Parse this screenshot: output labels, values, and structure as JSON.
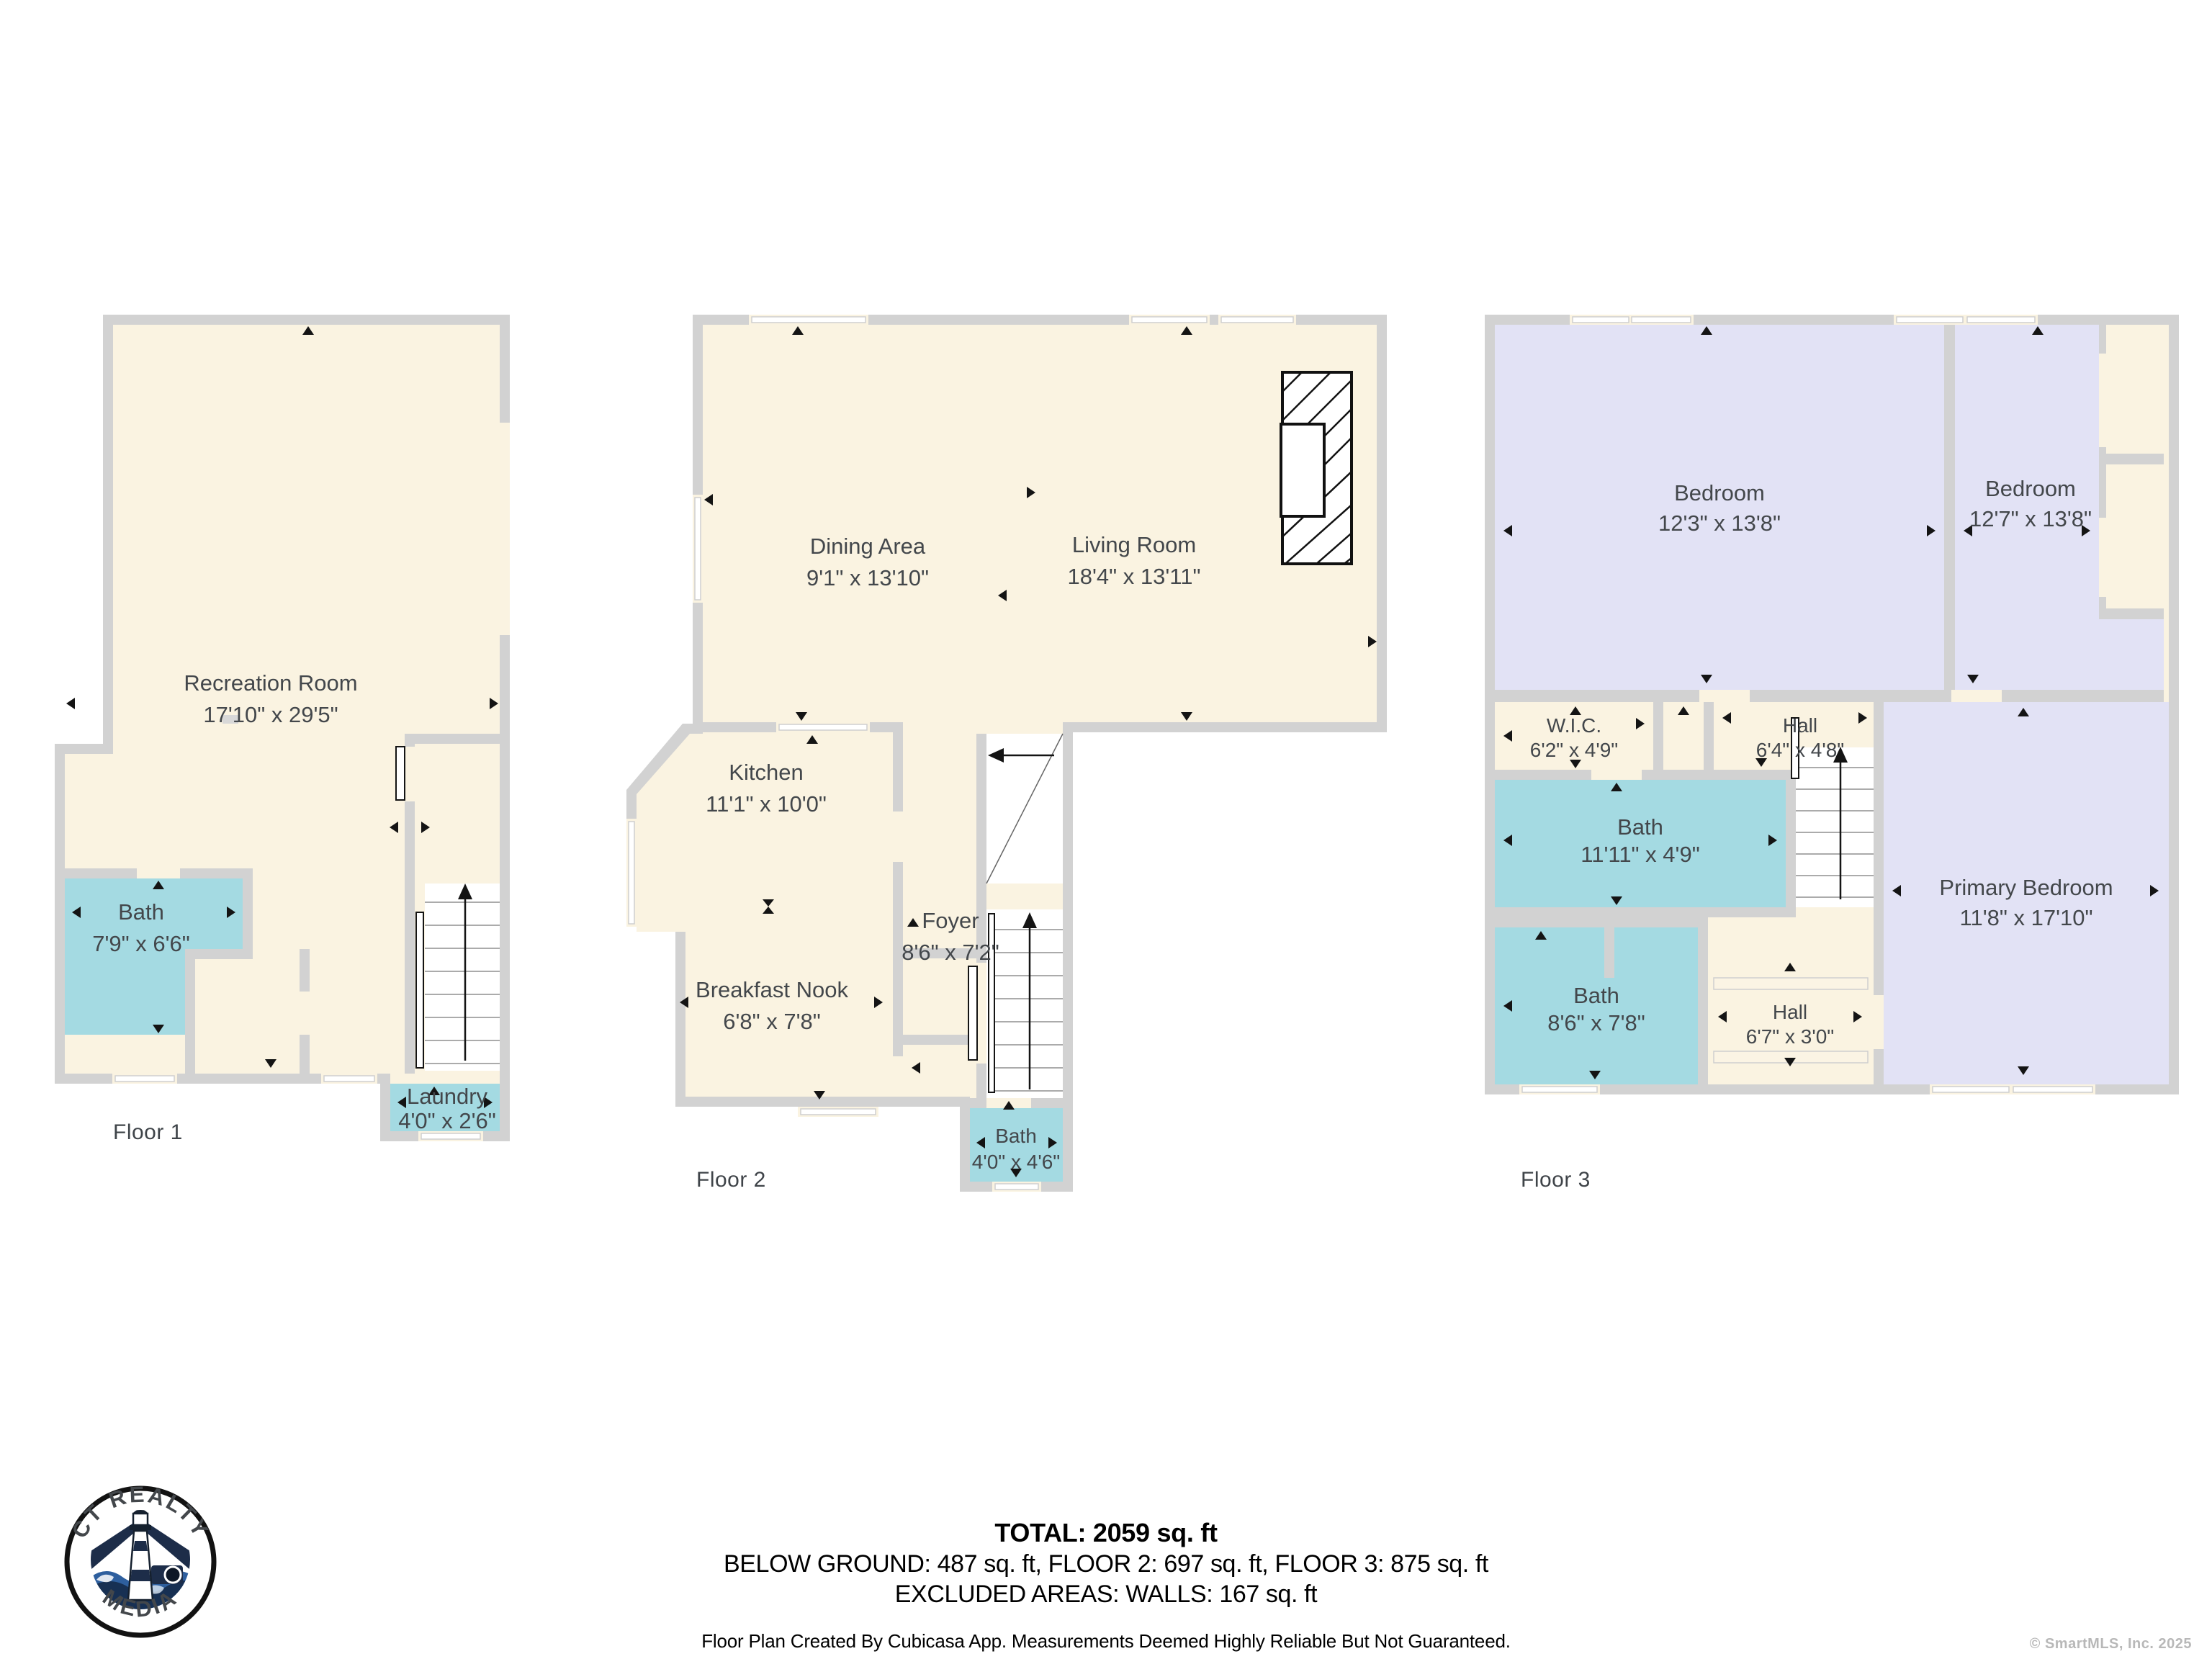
{
  "floors": [
    {
      "title": "Floor 1",
      "rooms": [
        {
          "name": "Recreation Room",
          "dims": "17'10\" x 29'5\""
        },
        {
          "name": "Bath",
          "dims": "7'9\" x 6'6\""
        },
        {
          "name": "Laundry",
          "dims": "4'0\" x 2'6\""
        }
      ]
    },
    {
      "title": "Floor 2",
      "rooms": [
        {
          "name": "Dining Area",
          "dims": "9'1\" x 13'10\""
        },
        {
          "name": "Living Room",
          "dims": "18'4\" x 13'11\""
        },
        {
          "name": "Kitchen",
          "dims": "11'1\" x 10'0\""
        },
        {
          "name": "Foyer",
          "dims": "8'6\" x 7'2\""
        },
        {
          "name": "Breakfast Nook",
          "dims": "6'8\" x 7'8\""
        },
        {
          "name": "Bath",
          "dims": "4'0\" x 4'6\""
        }
      ]
    },
    {
      "title": "Floor 3",
      "rooms": [
        {
          "name": "Bedroom",
          "dims": "12'3\" x 13'8\""
        },
        {
          "name": "Bedroom",
          "dims": "12'7\" x 13'8\""
        },
        {
          "name": "W.I.C.",
          "dims": "6'2\" x 4'9\""
        },
        {
          "name": "Hall",
          "dims": "6'4\" x 4'8\""
        },
        {
          "name": "Bath",
          "dims": "11'11\" x 4'9\""
        },
        {
          "name": "Primary Bedroom",
          "dims": "11'8\" x 17'10\""
        },
        {
          "name": "Bath",
          "dims": "8'6\" x 7'8\""
        },
        {
          "name": "Hall",
          "dims": "6'7\" x 3'0\""
        }
      ]
    }
  ],
  "summary": {
    "total": "TOTAL: 2059 sq. ft",
    "breakdown": "BELOW GROUND: 487 sq. ft, FLOOR 2: 697 sq. ft, FLOOR 3: 875 sq. ft",
    "excluded": "EXCLUDED AREAS: WALLS: 167 sq. ft",
    "disclaimer": "Floor Plan Created By Cubicasa App. Measurements Deemed Highly Reliable But Not Guaranteed."
  },
  "logo": {
    "arc_top": "CT REALTY",
    "arc_bottom": "MEDIA"
  },
  "copyright": "© SmartMLS, Inc.  2025",
  "colors": {
    "wall": "#d2d2d2",
    "floor_cream": "#faf3e1",
    "bath_teal": "#a4dae2",
    "bedroom_lavender": "#e2e2f5",
    "text": "#43474b",
    "logo_navy": "#1d2d49"
  }
}
